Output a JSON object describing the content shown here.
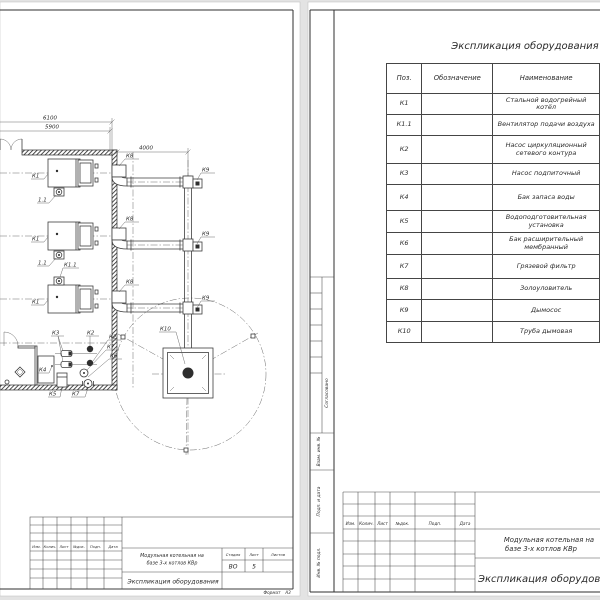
{
  "titles": {
    "project_line1": "Модульная котельная на",
    "project_line2": "базе 3-х котлов КВр",
    "doc_title": "Экспликация оборудования"
  },
  "stamp": {
    "rev_cols": [
      "Изм.",
      "Колич.",
      "Лист",
      "№док.",
      "Подп.",
      "Дата"
    ],
    "stage_label": "Стадия",
    "sheet_label": "Лист",
    "sheets_label": "Листов",
    "stage_value": "ВО",
    "sheet_value": "5",
    "format_label": "Формат",
    "format_value": "А3",
    "margin_labels": [
      "Согласовано",
      "Взам. инв. №",
      "Подп. и дата",
      "Инв. № подл."
    ]
  },
  "drawing": {
    "dimensions": {
      "width_outer": "6100",
      "width_inner": "5900",
      "flue_offset": "4000"
    },
    "labels": {
      "boiler": "К1",
      "fan_short": "1.1",
      "fan": "К1.1",
      "circ_pump": "К2",
      "makeup_pump": "К3",
      "tank": "К4",
      "water_treatment": "К5",
      "exp_tank": "К6",
      "filter": "К7",
      "ash_catcher": "К8",
      "smoke_exhauster": "К9",
      "chimney": "К10"
    }
  },
  "equipment_table": {
    "headers": [
      "Поз.",
      "Обозначение",
      "Наименование"
    ],
    "rows": [
      {
        "pos": "К1",
        "name": "Стальной водогрейный котёл"
      },
      {
        "pos": "К1.1",
        "name": "Вентилятор подачи воздуха"
      },
      {
        "pos": "К2",
        "name": "Насос циркуляционный сетевого контура"
      },
      {
        "pos": "К3",
        "name": "Насос подпиточный"
      },
      {
        "pos": "К4",
        "name": "Бак запаса воды"
      },
      {
        "pos": "К5",
        "name": "Водоподготовительная установка"
      },
      {
        "pos": "К6",
        "name": "Бак расширительный мембранный"
      },
      {
        "pos": "К7",
        "name": "Грязевой фильтр"
      },
      {
        "pos": "К8",
        "name": "Золоуловитель"
      },
      {
        "pos": "К9",
        "name": "Дымосос"
      },
      {
        "pos": "К10",
        "name": "Труба дымовая"
      }
    ]
  }
}
